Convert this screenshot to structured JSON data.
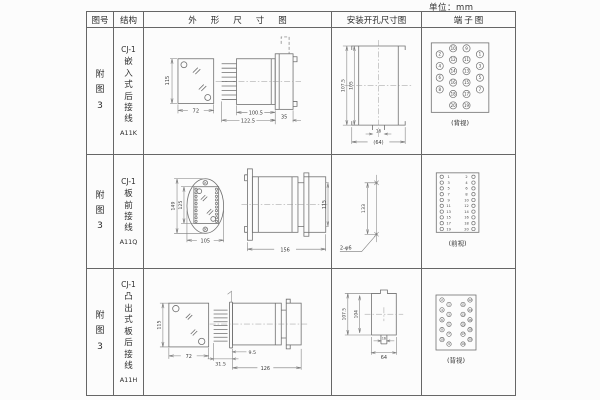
{
  "unit_label": "单位：mm",
  "header": {
    "fig_no": "图号",
    "structure": "结构",
    "outline": "外形尺寸图",
    "mounting": "安装开孔尺寸图",
    "terminal": "端子图"
  },
  "rows": [
    {
      "fig_no": "附\n图\n3",
      "model": "CJ-1",
      "structure_chars": "嵌\n入\n式\n后\n接\n线",
      "code": "A11K",
      "outline": {
        "front_height": "115",
        "front_width": "72",
        "side_body": "100.5",
        "side_overall": "122.5",
        "side_panel": "35"
      },
      "mounting": {
        "outer_height": "107.5",
        "inner_height": "105",
        "slot_width": "16",
        "overall_width": "(64)"
      },
      "terminal": {
        "caption": "(背视)",
        "outer_left": [
          "2",
          "4",
          "6",
          "8"
        ],
        "mid_left": [
          "10",
          "12",
          "14",
          "16",
          "18",
          "20"
        ],
        "mid_right": [
          "9",
          "11",
          "13",
          "15",
          "17",
          "19"
        ],
        "outer_right": [
          "1",
          "3",
          "5",
          "7"
        ]
      }
    },
    {
      "fig_no": "附\n图\n3",
      "model": "CJ-1",
      "structure_chars": "板\n前\n接\n线",
      "code": "A11Q",
      "outline": {
        "front_outer_height": "149",
        "front_inner_height": "125",
        "front_width": "105",
        "side_length": "156",
        "side_height": "115"
      },
      "mounting": {
        "hole_spacing": "133",
        "hole_note": "2-φ6"
      },
      "terminal": {
        "caption": "(前视)",
        "left": [
          "1",
          "3",
          "5",
          "7",
          "9",
          "11",
          "13",
          "15",
          "17",
          "19"
        ],
        "right": [
          "2",
          "4",
          "6",
          "8",
          "10",
          "12",
          "14",
          "16",
          "18",
          "20"
        ]
      }
    },
    {
      "fig_no": "附\n图\n3",
      "model": "CJ-1",
      "structure_chars": "凸\n出\n式\n板\n后\n接\n线",
      "code": "A11H",
      "outline": {
        "front_height": "115",
        "front_width": "72",
        "pin_depth": "31.5",
        "flange_offset": "9.5",
        "side_length": "126"
      },
      "mounting": {
        "outer_height": "107.5",
        "inner_height": "104",
        "slot_width": "16",
        "overall_width": "64"
      },
      "terminal": {
        "caption": "(背视)",
        "left_group": [
          "2",
          "1",
          "4",
          "3",
          "6",
          "5",
          "8",
          "7",
          "10",
          "9"
        ],
        "right_group": [
          "12",
          "11",
          "14",
          "13",
          "16",
          "15",
          "18",
          "17",
          "20",
          "19"
        ]
      }
    }
  ]
}
